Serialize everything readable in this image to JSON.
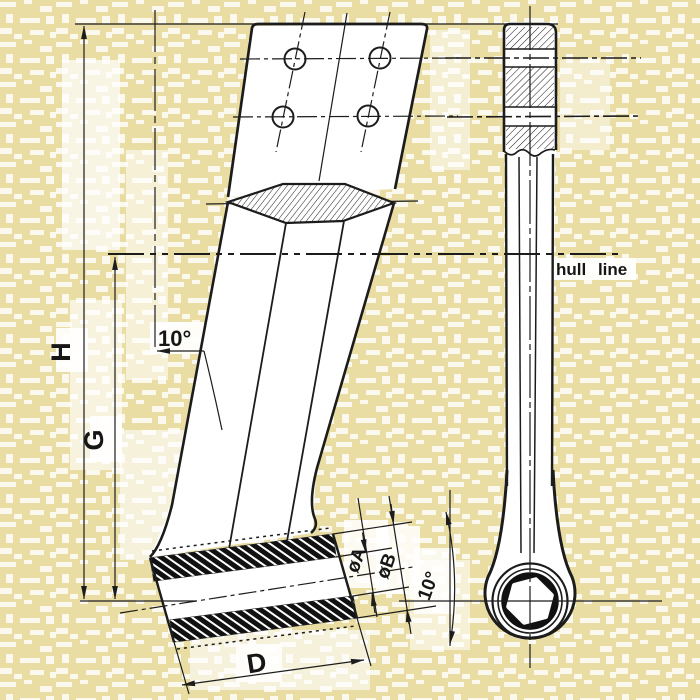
{
  "drawing": {
    "colors": {
      "paper": "#e9dda4",
      "ink": "#1c1c1c",
      "patch": "#ffffff"
    },
    "annotations": {
      "hull_line": "hull line",
      "rake_angle": "10°",
      "boss_angle": "10°",
      "dim_overall_height": "H",
      "dim_hull_height": "G",
      "dim_boss_length": "D",
      "dim_bore_diameter": "øA",
      "dim_boss_outer_diameter": "øB"
    }
  }
}
